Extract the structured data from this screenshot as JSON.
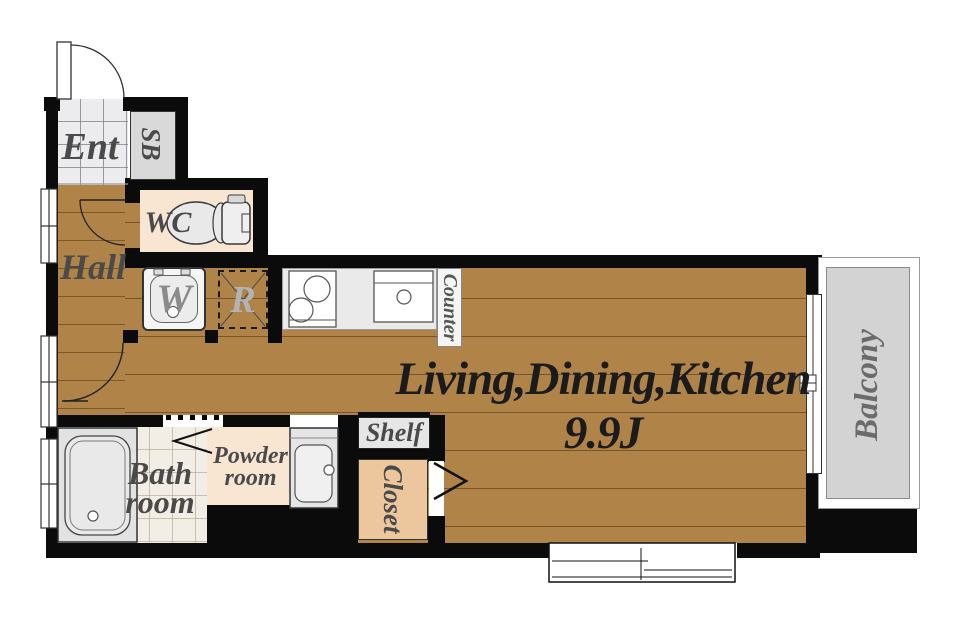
{
  "floor_plan": {
    "ldk": {
      "name": "Living,Dining,Kitchen",
      "size": "9.9J"
    },
    "labels": {
      "ent": "Ent",
      "sb": "SB",
      "wc": "WC",
      "hall": "Hall",
      "washer": "W",
      "refrigerator": "R",
      "counter": "Counter",
      "shelf": "Shelf",
      "closet": "Closet",
      "bath_line1": "Bath",
      "bath_line2": "room",
      "powder_line1": "Powder",
      "powder_line2": "room",
      "balcony": "Balcony"
    },
    "colors": {
      "wood_floor": "#b08448",
      "wall": "#0b0b0b",
      "room_peach": "#f8e5d2",
      "closet_tan": "#ecc79e",
      "fixture_gray": "#e3e3e3",
      "balcony_gray": "#d3d3d3",
      "entry_tile": "#ececee",
      "bath_tile": "#f2ede5",
      "label_text": "#4a4a4a",
      "title_text": "#1b1b1b"
    }
  }
}
